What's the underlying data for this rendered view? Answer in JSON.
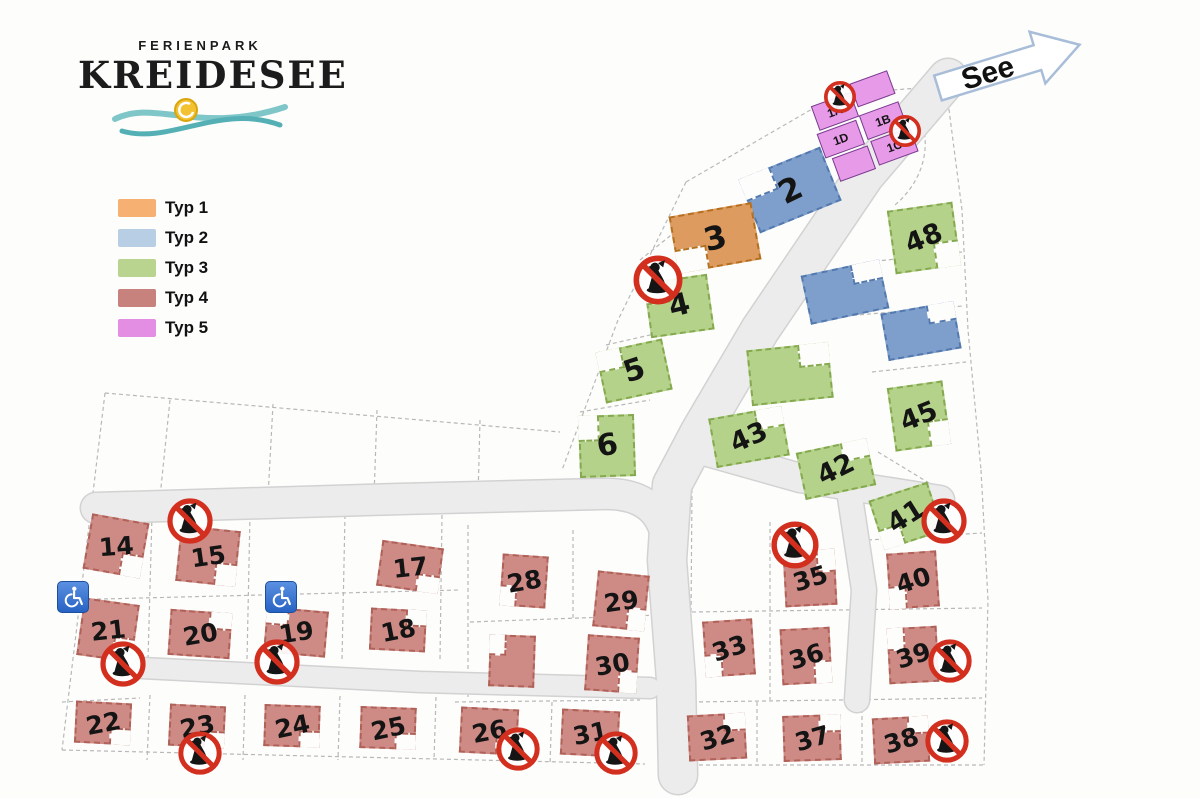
{
  "logo": {
    "top": "FERIENPARK",
    "main": "KREIDESEE"
  },
  "see": {
    "label": "See"
  },
  "legend": {
    "items": [
      {
        "label": "Typ 1",
        "color": "#F6B072"
      },
      {
        "label": "Typ 2",
        "color": "#B7CEE5"
      },
      {
        "label": "Typ 3",
        "color": "#B8D48E"
      },
      {
        "label": "Typ 4",
        "color": "#C8827E"
      },
      {
        "label": "Typ 5",
        "color": "#E38DE3"
      }
    ]
  },
  "map": {
    "building_colors": {
      "t1": {
        "bg": "#DD9B5F",
        "bd": "#B5701F"
      },
      "t2": {
        "bg": "#7E9FCC",
        "bd": "#5379AE"
      },
      "t3": {
        "bg": "#B4D289",
        "bd": "#85A94F"
      },
      "t4": {
        "bg": "#CE8B86",
        "bd": "#B06158"
      },
      "t5": {
        "bg": "#E79AE8",
        "bd": "#7A3E8F"
      }
    },
    "cluster": {
      "x": 863,
      "y": 131,
      "r": -20,
      "cells": [
        {
          "l": "1A",
          "x": 4,
          "y": 2,
          "w": 42,
          "h": 26
        },
        {
          "l": "",
          "x": 48,
          "y": -6,
          "w": 40,
          "h": 25
        },
        {
          "l": "1D",
          "x": 0,
          "y": 30,
          "w": 42,
          "h": 26
        },
        {
          "l": "1B",
          "x": 46,
          "y": 27,
          "w": 42,
          "h": 26
        },
        {
          "l": "",
          "x": 6,
          "y": 58,
          "w": 38,
          "h": 25
        },
        {
          "l": "1C",
          "x": 48,
          "y": 55,
          "w": 42,
          "h": 26
        }
      ]
    },
    "buildings": [
      {
        "l": "2",
        "t": "t2",
        "x": 790,
        "y": 190,
        "w": 88,
        "h": 58,
        "r": -22,
        "fs": 32,
        "lr": -4,
        "n": "tl"
      },
      {
        "l": "3",
        "t": "t1",
        "x": 715,
        "y": 238,
        "w": 84,
        "h": 58,
        "r": -10,
        "fs": 32,
        "lr": -4,
        "n": "bl"
      },
      {
        "l": "48",
        "t": "t3",
        "x": 924,
        "y": 238,
        "w": 66,
        "h": 64,
        "r": -8,
        "fs": 27,
        "n": "br"
      },
      {
        "l": "",
        "t": "t2",
        "x": 845,
        "y": 292,
        "w": 80,
        "h": 50,
        "r": -12,
        "n": "tr"
      },
      {
        "l": "",
        "t": "t2",
        "x": 921,
        "y": 331,
        "w": 74,
        "h": 48,
        "r": -10,
        "n": "tr"
      },
      {
        "l": "4",
        "t": "t3",
        "x": 679,
        "y": 306,
        "w": 64,
        "h": 56,
        "r": -8,
        "fs": 30,
        "lr": -6,
        "n": "tl"
      },
      {
        "l": "5",
        "t": "t3",
        "x": 634,
        "y": 371,
        "w": 68,
        "h": 52,
        "r": -12,
        "fs": 30,
        "lr": -6,
        "n": "tl"
      },
      {
        "l": "",
        "t": "t3",
        "x": 790,
        "y": 374,
        "w": 82,
        "h": 56,
        "r": -6,
        "n": "tr"
      },
      {
        "l": "45",
        "t": "t3",
        "x": 919,
        "y": 416,
        "w": 56,
        "h": 64,
        "r": -8,
        "fs": 27,
        "n": "br"
      },
      {
        "l": "6",
        "t": "t3",
        "x": 607,
        "y": 446,
        "w": 56,
        "h": 62,
        "r": -2,
        "fs": 30,
        "lr": -8,
        "n": "tl"
      },
      {
        "l": "43",
        "t": "t3",
        "x": 749,
        "y": 437,
        "w": 74,
        "h": 50,
        "r": -10,
        "fs": 27,
        "n": "tr"
      },
      {
        "l": "42",
        "t": "t3",
        "x": 836,
        "y": 469,
        "w": 72,
        "h": 48,
        "r": -12,
        "fs": 27,
        "n": "tr"
      },
      {
        "l": "41",
        "t": "t3",
        "x": 906,
        "y": 516,
        "w": 62,
        "h": 52,
        "r": -18,
        "fs": 27,
        "n": "bl"
      },
      {
        "l": "14",
        "t": "t4",
        "x": 116,
        "y": 546,
        "w": 58,
        "h": 56,
        "r": 10,
        "fs": 25,
        "n": "br"
      },
      {
        "l": "15",
        "t": "t4",
        "x": 208,
        "y": 556,
        "w": 60,
        "h": 56,
        "r": 6,
        "fs": 25,
        "n": "br"
      },
      {
        "l": "17",
        "t": "t4",
        "x": 410,
        "y": 567,
        "w": 62,
        "h": 46,
        "r": 8,
        "fs": 25,
        "n": "br"
      },
      {
        "l": "28",
        "t": "t4",
        "x": 524,
        "y": 581,
        "w": 46,
        "h": 52,
        "r": 4,
        "fs": 25,
        "n": "bl"
      },
      {
        "l": "29",
        "t": "t4",
        "x": 621,
        "y": 601,
        "w": 52,
        "h": 56,
        "r": 6,
        "fs": 25,
        "n": "br"
      },
      {
        "l": "21",
        "t": "t4",
        "x": 108,
        "y": 630,
        "w": 56,
        "h": 58,
        "r": 8,
        "fs": 25,
        "n": "br"
      },
      {
        "l": "20",
        "t": "t4",
        "x": 200,
        "y": 634,
        "w": 62,
        "h": 46,
        "r": 4,
        "fs": 25,
        "n": "tr"
      },
      {
        "l": "19",
        "t": "t4",
        "x": 296,
        "y": 632,
        "w": 62,
        "h": 46,
        "r": 5,
        "fs": 25,
        "n": "tl"
      },
      {
        "l": "18",
        "t": "t4",
        "x": 398,
        "y": 630,
        "w": 56,
        "h": 42,
        "r": 3,
        "fs": 25,
        "n": "tr"
      },
      {
        "l": "",
        "t": "t4",
        "x": 512,
        "y": 661,
        "w": 46,
        "h": 52,
        "r": 2,
        "n": "tl"
      },
      {
        "l": "30",
        "t": "t4",
        "x": 612,
        "y": 664,
        "w": 52,
        "h": 56,
        "r": 4,
        "fs": 25,
        "n": "br"
      },
      {
        "l": "33",
        "t": "t4",
        "x": 729,
        "y": 648,
        "w": 50,
        "h": 56,
        "r": -4,
        "fs": 25,
        "n": "bl"
      },
      {
        "l": "35",
        "t": "t4",
        "x": 810,
        "y": 578,
        "w": 52,
        "h": 56,
        "r": -3,
        "fs": 25,
        "n": "tr"
      },
      {
        "l": "40",
        "t": "t4",
        "x": 913,
        "y": 580,
        "w": 50,
        "h": 56,
        "r": -4,
        "fs": 25,
        "n": "bl"
      },
      {
        "l": "36",
        "t": "t4",
        "x": 806,
        "y": 656,
        "w": 50,
        "h": 56,
        "r": -3,
        "fs": 25,
        "n": "br"
      },
      {
        "l": "39",
        "t": "t4",
        "x": 913,
        "y": 655,
        "w": 50,
        "h": 56,
        "r": -3,
        "fs": 25,
        "n": "tl"
      },
      {
        "l": "22",
        "t": "t4",
        "x": 103,
        "y": 723,
        "w": 56,
        "h": 42,
        "r": 3,
        "fs": 25,
        "n": "br"
      },
      {
        "l": "23",
        "t": "t4",
        "x": 197,
        "y": 726,
        "w": 56,
        "h": 42,
        "r": 3,
        "fs": 25,
        "n": "br"
      },
      {
        "l": "24",
        "t": "t4",
        "x": 292,
        "y": 726,
        "w": 56,
        "h": 42,
        "r": 2,
        "fs": 25,
        "n": "br"
      },
      {
        "l": "25",
        "t": "t4",
        "x": 388,
        "y": 728,
        "w": 56,
        "h": 42,
        "r": 2,
        "fs": 25,
        "n": "br"
      },
      {
        "l": "26",
        "t": "t4",
        "x": 489,
        "y": 731,
        "w": 58,
        "h": 46,
        "r": 3,
        "fs": 25,
        "n": "br"
      },
      {
        "l": "31",
        "t": "t4",
        "x": 590,
        "y": 733,
        "w": 58,
        "h": 46,
        "r": 3,
        "fs": 25,
        "n": "br"
      },
      {
        "l": "32",
        "t": "t4",
        "x": 717,
        "y": 737,
        "w": 58,
        "h": 46,
        "r": -3,
        "fs": 25,
        "n": "tr"
      },
      {
        "l": "37",
        "t": "t4",
        "x": 812,
        "y": 738,
        "w": 58,
        "h": 46,
        "r": -2,
        "fs": 25,
        "n": "tr"
      },
      {
        "l": "38",
        "t": "t4",
        "x": 901,
        "y": 740,
        "w": 56,
        "h": 46,
        "r": -3,
        "fs": 25,
        "n": "tr"
      }
    ],
    "no_dogs": [
      {
        "x": 840,
        "y": 97,
        "s": 34
      },
      {
        "x": 905,
        "y": 131,
        "s": 34
      },
      {
        "x": 658,
        "y": 280,
        "s": 52
      },
      {
        "x": 190,
        "y": 521,
        "s": 48
      },
      {
        "x": 123,
        "y": 664,
        "s": 48
      },
      {
        "x": 277,
        "y": 662,
        "s": 48
      },
      {
        "x": 200,
        "y": 753,
        "s": 46
      },
      {
        "x": 518,
        "y": 749,
        "s": 46
      },
      {
        "x": 616,
        "y": 753,
        "s": 46
      },
      {
        "x": 795,
        "y": 545,
        "s": 50
      },
      {
        "x": 944,
        "y": 521,
        "s": 48
      },
      {
        "x": 950,
        "y": 661,
        "s": 46
      },
      {
        "x": 947,
        "y": 741,
        "s": 46
      }
    ],
    "wheelchairs": [
      {
        "x": 73,
        "y": 597
      },
      {
        "x": 281,
        "y": 597
      }
    ]
  }
}
